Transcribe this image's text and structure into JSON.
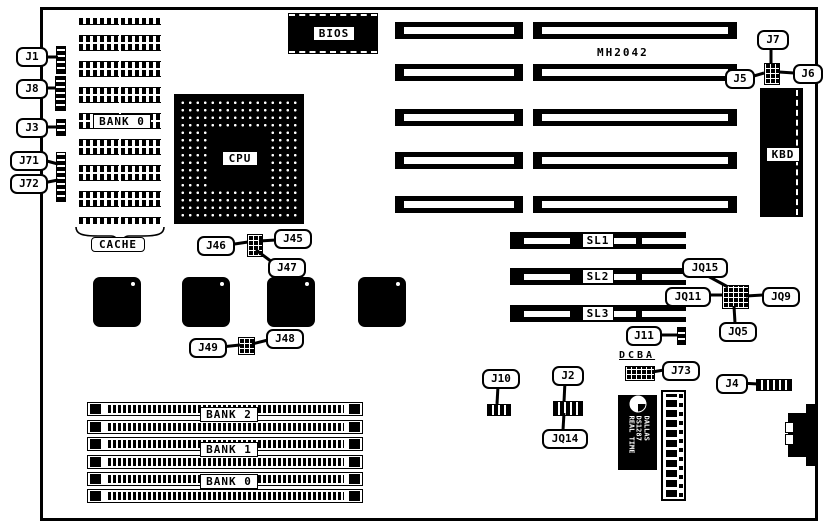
{
  "board": {
    "model": "MH2042"
  },
  "chips": {
    "bios": "BIOS",
    "cpu": "CPU",
    "kbd": "KBD",
    "dallas_line1": "DALLAS",
    "dallas_line2": "DS1287",
    "dallas_line3": "REAL TIME"
  },
  "labels": {
    "cache_bank": "BANK 0",
    "cache": "CACHE",
    "dcba": "DCBA",
    "slot1": "SL1",
    "slot2": "SL2",
    "slot3": "SL3",
    "simm_bank2": "BANK 2",
    "simm_bank1": "BANK 1",
    "simm_bank0": "BANK 0"
  },
  "callouts": {
    "j1": "J1",
    "j8": "J8",
    "j3": "J3",
    "j71": "J71",
    "j72": "J72",
    "j46": "J46",
    "j45": "J45",
    "j47": "J47",
    "j49": "J49",
    "j48": "J48",
    "j5": "J5",
    "j6": "J6",
    "j7": "J7",
    "jq15": "JQ15",
    "jq11": "JQ11",
    "jq9": "JQ9",
    "jq5": "JQ5",
    "j11": "J11",
    "j10": "J10",
    "j2": "J2",
    "jq14": "JQ14",
    "j73": "J73",
    "j4": "J4"
  },
  "colors": {
    "ink": "#000000",
    "paper": "#ffffff"
  }
}
